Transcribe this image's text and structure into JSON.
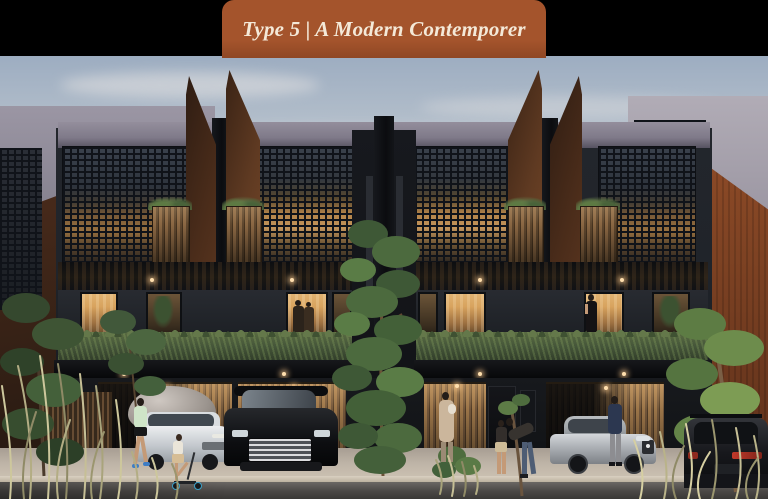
{
  "banner": {
    "title": "Type 5 | A Modern Contemporer"
  },
  "colors": {
    "page_bg": "#000000",
    "banner_bg": "#a4542c",
    "banner_bg_dark": "#8f4724",
    "banner_text": "#f4e9d8",
    "sky_top": "#9dadc1",
    "sky_mid": "#c2c9d2",
    "sky_horizon": "#d9d3d1",
    "cloud": "#e9e6e4",
    "concrete": "#9b96a4",
    "concrete_light": "#b1acb6",
    "corten_bright": "#8e4b27",
    "charcoal": "#20242a",
    "screen_line": "#101319",
    "glow": "#97703f",
    "glass_warm": "#d8a35e",
    "wood": "#9a7448",
    "wood_dark": "#4e3a26",
    "hedge": "#46573a",
    "hedge_light": "#64784a",
    "grass_khaki": "#c6bf96",
    "pavement": "#beb4a7",
    "curb": "#d9d0c1",
    "road": "#4a4745",
    "slab": "#0c0d10",
    "skin": "#c49a77"
  }
}
